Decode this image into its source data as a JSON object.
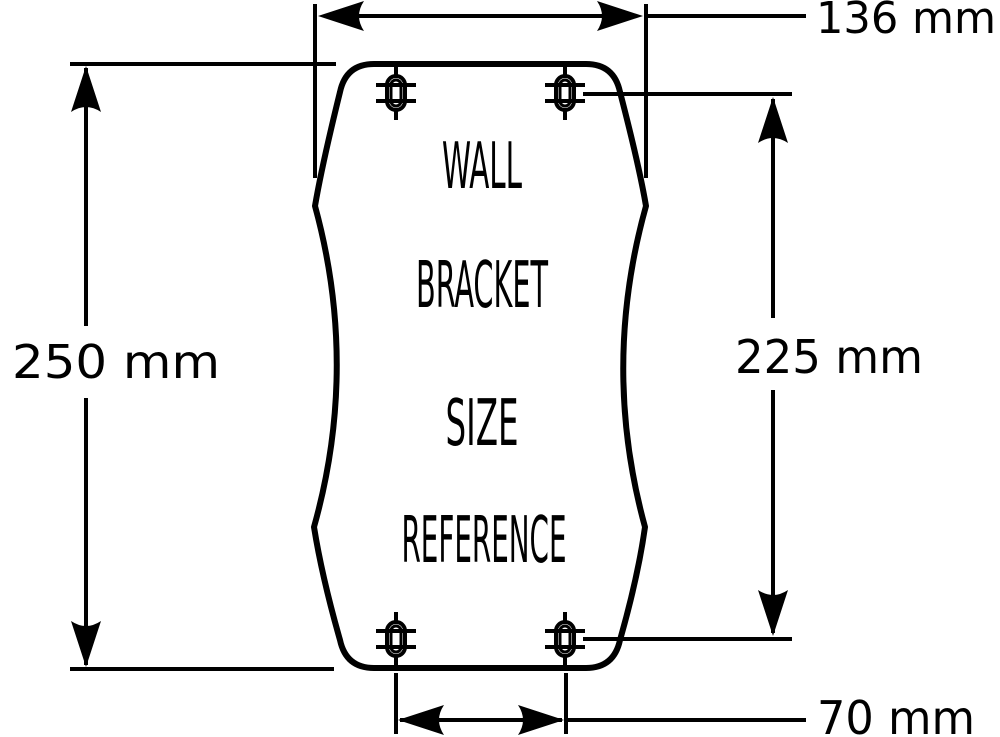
{
  "drawing": {
    "bracket_label_lines": [
      "WALL",
      "BRACKET",
      "SIZE",
      "REFERENCE"
    ],
    "dimensions": {
      "overall_width": "136 mm",
      "overall_height": "250 mm",
      "hole_spacing_vertical": "225 mm",
      "hole_spacing_horizontal": "70 mm"
    },
    "colors": {
      "line": "#000000",
      "background": "#ffffff"
    }
  }
}
